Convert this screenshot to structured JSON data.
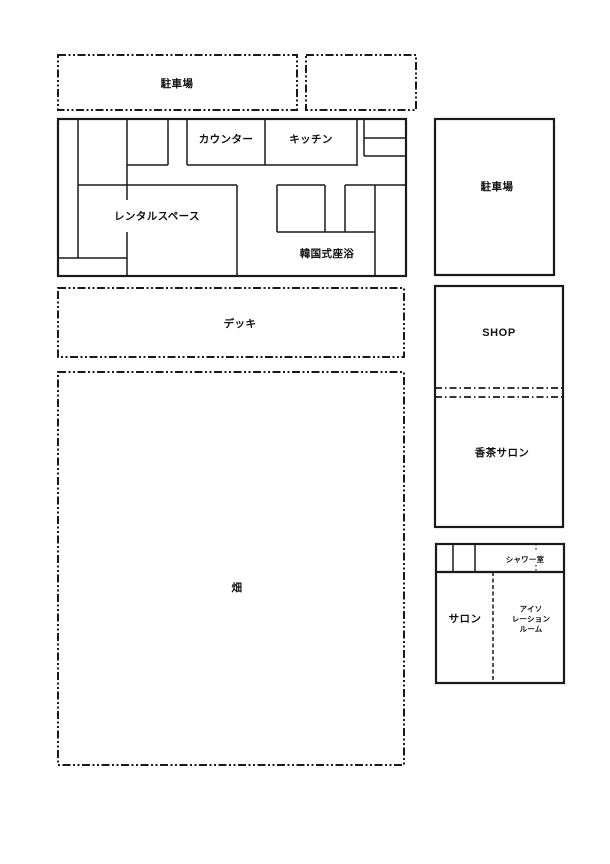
{
  "colors": {
    "line": "#1a1a1a",
    "background": "#ffffff",
    "text": "#111111"
  },
  "outdoor": {
    "parking_top": "駐車場",
    "deck": "デッキ",
    "field": "畑"
  },
  "building": {
    "counter": "カウンター",
    "kitchen": "キッチン",
    "rental_space": "レンタルスペース",
    "korean_sitz_bath": "韓国式座浴"
  },
  "annex": {
    "parking": "駐車場",
    "shop": "SHOP",
    "tea_salon": "香茶サロン",
    "salon": "サロン",
    "shower_room": "シャワー室",
    "isolation_room": [
      "アイソ",
      "レーション",
      "ルーム"
    ]
  }
}
